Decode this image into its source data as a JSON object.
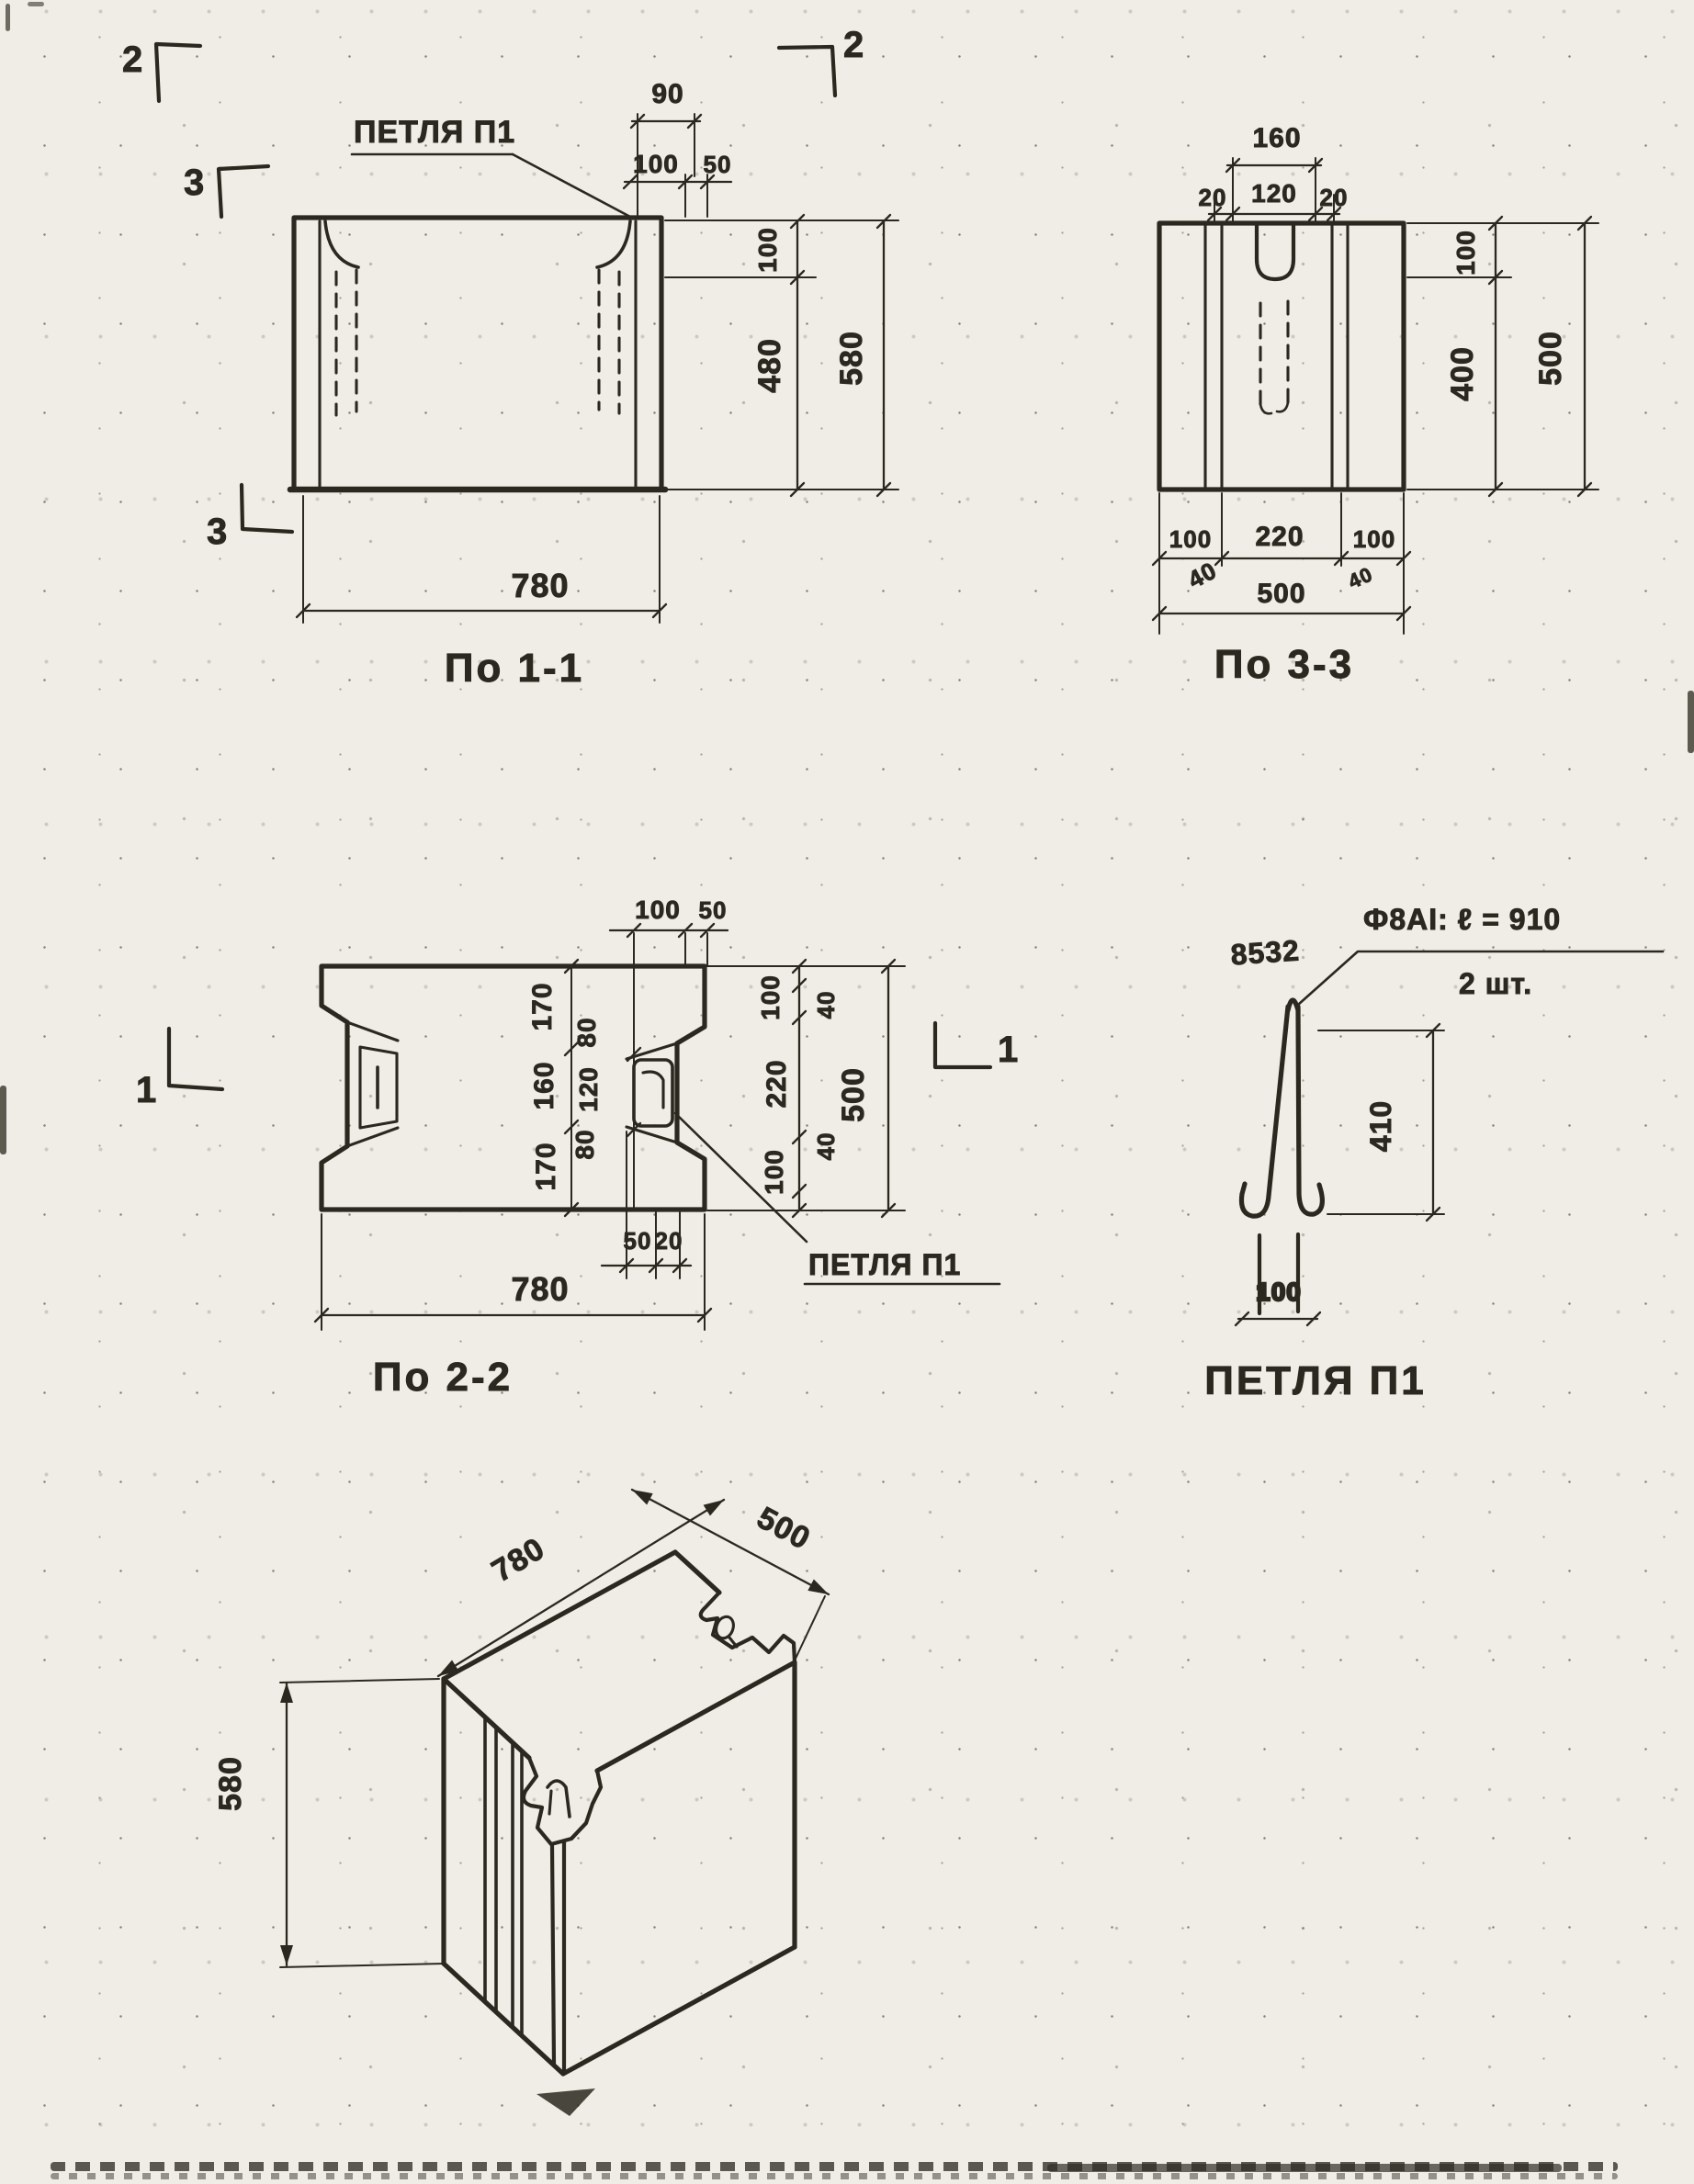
{
  "palette": {
    "paper": "#efede5",
    "ink": "#2b2820"
  },
  "po11": {
    "title": "По 1-1",
    "loop_label": "ПЕТЛЯ П1",
    "marks": {
      "top_left": "2",
      "left": "3",
      "bottom_left": "3",
      "top_right": "2"
    },
    "dims": {
      "t90": "90",
      "t100": "100",
      "t50": "50",
      "r100": "100",
      "r480": "480",
      "r580": "580",
      "b780": "780"
    }
  },
  "po33": {
    "title": "По 3-3",
    "dims": {
      "t160": "160",
      "t20l": "20",
      "t120": "120",
      "t20r": "20",
      "r100": "100",
      "r400": "400",
      "r500": "500",
      "b100l": "100",
      "b220": "220",
      "b100r": "100",
      "b40l": "40",
      "b500": "500",
      "b40r": "40"
    }
  },
  "po22": {
    "title": "По 2-2",
    "loop_label": "ПЕТЛЯ П1",
    "marks": {
      "left": "1",
      "right": "1"
    },
    "dims": {
      "t100": "100",
      "t50": "50",
      "c170a": "170",
      "c160": "160",
      "c170b": "170",
      "c80a": "80",
      "c120": "120",
      "c80b": "80",
      "r100a": "100",
      "r220": "220",
      "r100b": "100",
      "r40a": "40",
      "r40b": "40",
      "r500": "500",
      "b50": "50",
      "b20": "20",
      "b780": "780"
    }
  },
  "loop_detail": {
    "title": "ПЕТЛЯ П1",
    "mark": "8532",
    "note_line1": "Ф8АI: ℓ = 910",
    "note_line2": "2 шт.",
    "dims": {
      "height": "410",
      "width": "100"
    }
  },
  "iso": {
    "dims": {
      "width": "780",
      "depth": "500",
      "height": "580"
    }
  }
}
